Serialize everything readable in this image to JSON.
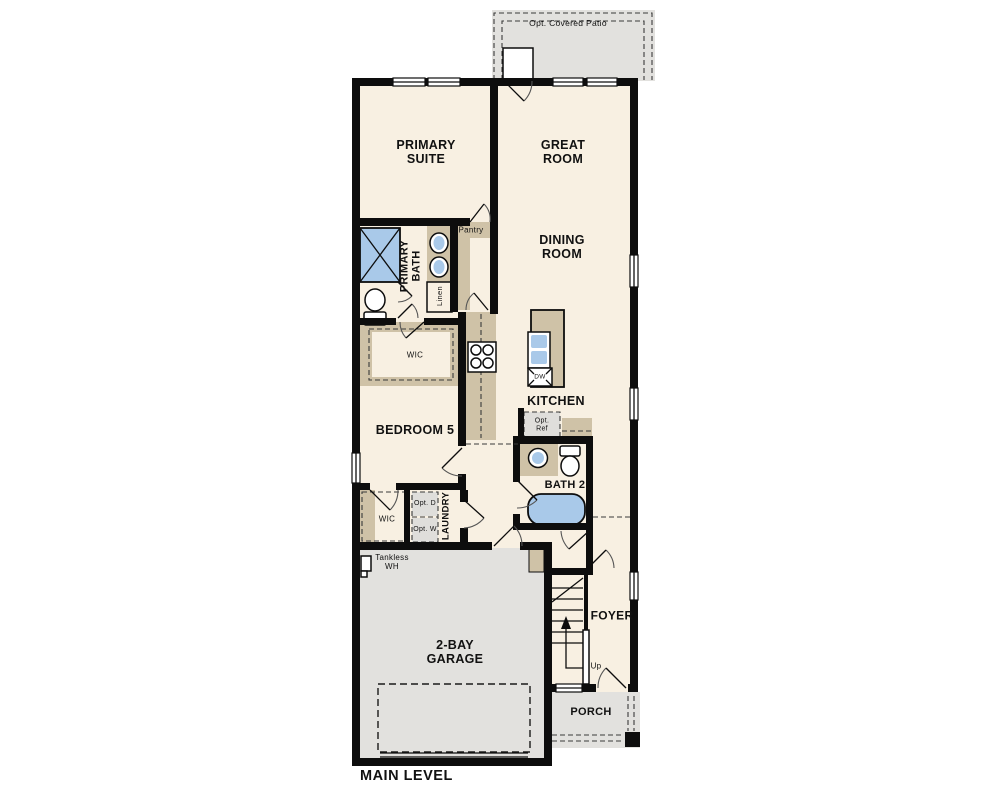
{
  "plan": {
    "title": "MAIN LEVEL",
    "colors": {
      "floor": "#f8f0e2",
      "area": "#e2e1de",
      "wall": "#0d0d0d",
      "cab": "#cfc2a7",
      "blue": "#a9c9e9",
      "opt": "#dfdedb",
      "text": "#111111"
    },
    "labels": {
      "patio": "Opt. Covered Patio",
      "primary_suite": "PRIMARY SUITE",
      "great_room": "GREAT ROOM",
      "dining_room": "DINING ROOM",
      "primary_bath": "PRIMARY BATH",
      "pantry": "Pantry",
      "linen": "Linen",
      "wic_primary": "WIC",
      "kitchen": "KITCHEN",
      "dishwasher": "DW",
      "opt_ref": "Opt. Ref",
      "bedroom5": "BEDROOM 5",
      "bath2": "BATH 2",
      "wic_bedroom5": "WIC",
      "opt_dryer": "Opt. D",
      "opt_washer": "Opt. W",
      "laundry": "LAUNDRY",
      "tankless_wh": "Tankless WH",
      "garage": "2-BAY GARAGE",
      "foyer": "FOYER",
      "stairs_up": "Up",
      "porch": "PORCH"
    }
  }
}
